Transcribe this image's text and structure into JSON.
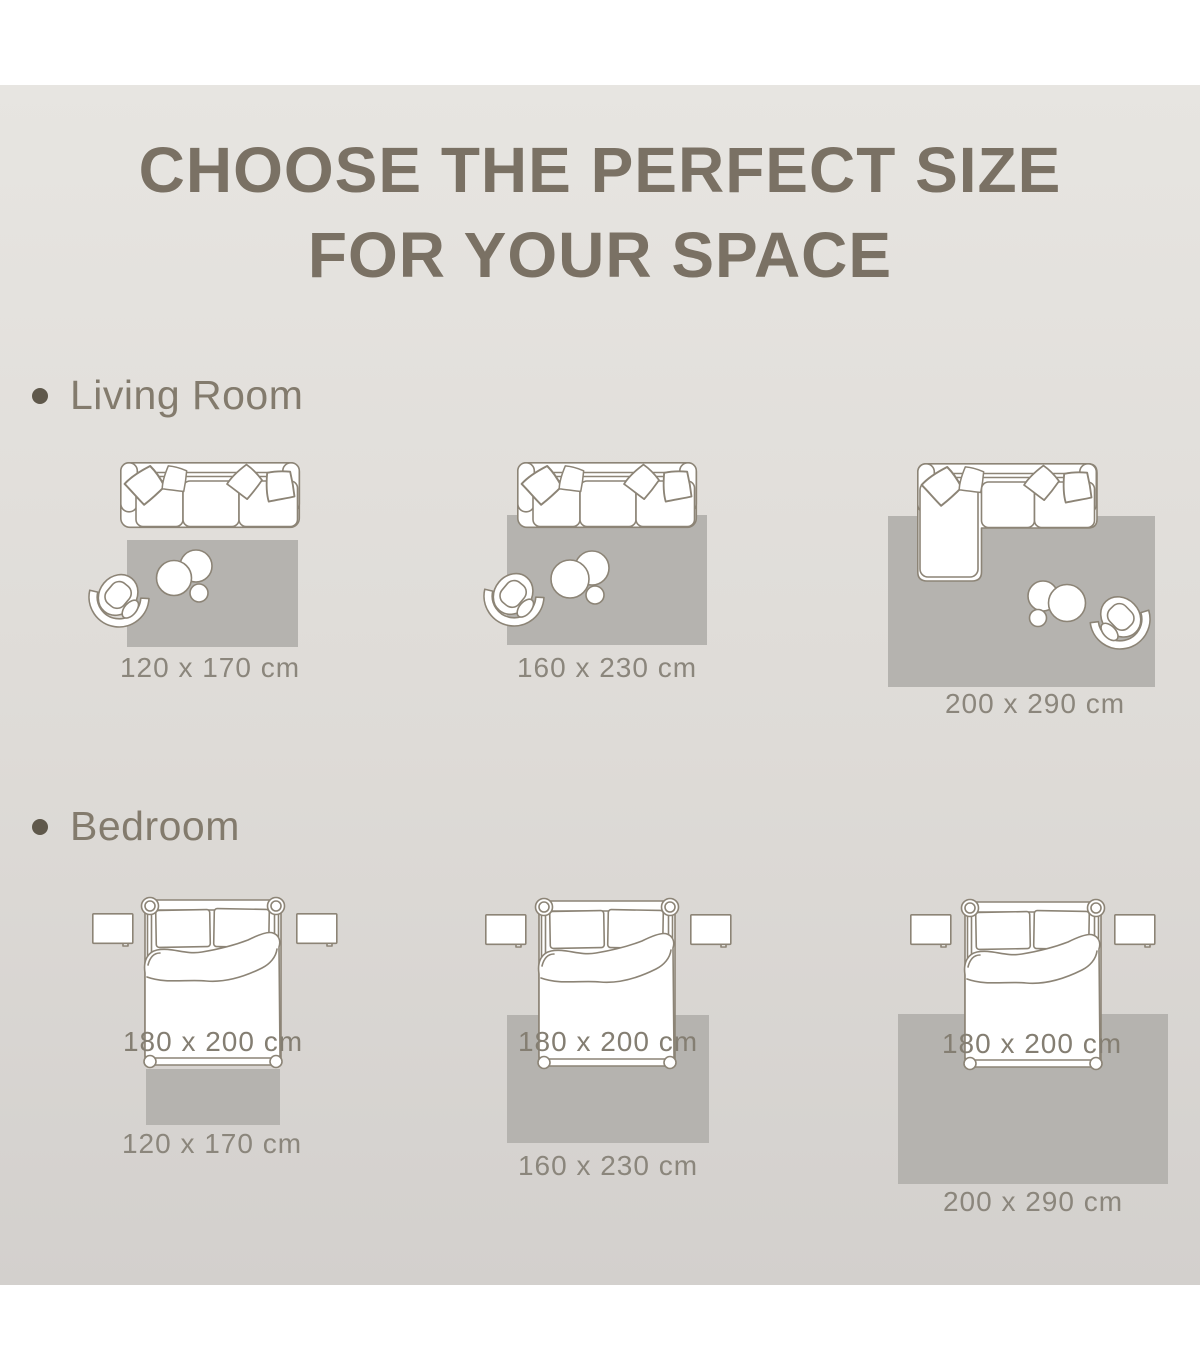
{
  "title": {
    "line1": "CHOOSE THE PERFECT SIZE",
    "line2": "FOR YOUR SPACE"
  },
  "sections": {
    "living_room": {
      "label": "Living Room",
      "sizes": [
        "120 x 170 cm",
        "160 x 230 cm",
        "200 x 290 cm"
      ]
    },
    "bedroom": {
      "label": "Bedroom",
      "bed_size": "180 x 200 cm",
      "sizes": [
        "120 x 170 cm",
        "160 x 230 cm",
        "200 x 290 cm"
      ]
    }
  },
  "colors": {
    "page_background": "#ffffff",
    "panel_top": "#e7e5e1",
    "panel_bottom": "#d3d0cd",
    "rug_fill": "#b5b3af",
    "furniture_outline": "#8c8476",
    "furniture_fill": "#ffffff",
    "title_text": "#7a7164",
    "section_text": "#837b6d",
    "size_label_text": "#8b867c",
    "bullet": "#5f584b"
  }
}
